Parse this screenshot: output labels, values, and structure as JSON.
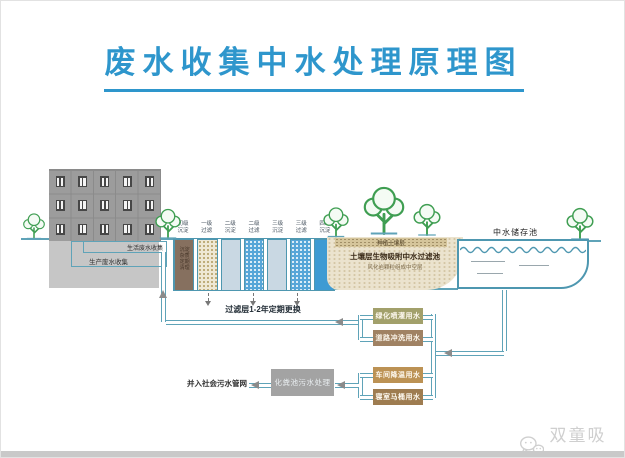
{
  "title": "废水收集中水处理原理图",
  "colors": {
    "accent_blue": "#2e96cc",
    "pipe_teal": "#5fa3b8",
    "box_irrigation": "#a2a06b",
    "box_road": "#a08263",
    "box_workshop": "#bc9254",
    "box_toilet": "#9e7c50",
    "septic_gray": "#a3a3a3"
  },
  "building": {
    "domestic_label": "生活废水收集",
    "production_label": "生产废水收集"
  },
  "tanks": {
    "items": [
      {
        "label": "初级沉淀",
        "note": "沉淀杂质定期清理"
      },
      {
        "label": "一级过滤"
      },
      {
        "label": "二级沉淀"
      },
      {
        "label": "二级过滤"
      },
      {
        "label": "三级沉淀"
      },
      {
        "label": "三级过滤"
      },
      {
        "label": "四级沉淀"
      }
    ],
    "footnote": "过滤层1-2年定期更换"
  },
  "soil": {
    "top_label": "种植土壤层",
    "main_label": "土壤层生物吸附中水过滤池",
    "sub_label": "风化岩颗粒组成中空层"
  },
  "pool": {
    "label": "中水储存池"
  },
  "reuse_boxes": [
    {
      "label": "绿化喷灌用水"
    },
    {
      "label": "道路冲洗用水"
    },
    {
      "label": "车间降温用水"
    },
    {
      "label": "寝室马桶用水"
    }
  ],
  "septic": {
    "box_label": "化粪池污水处理",
    "sewer_label": "并入社会污水管网"
  },
  "watermark": {
    "label": "双童吸管"
  }
}
